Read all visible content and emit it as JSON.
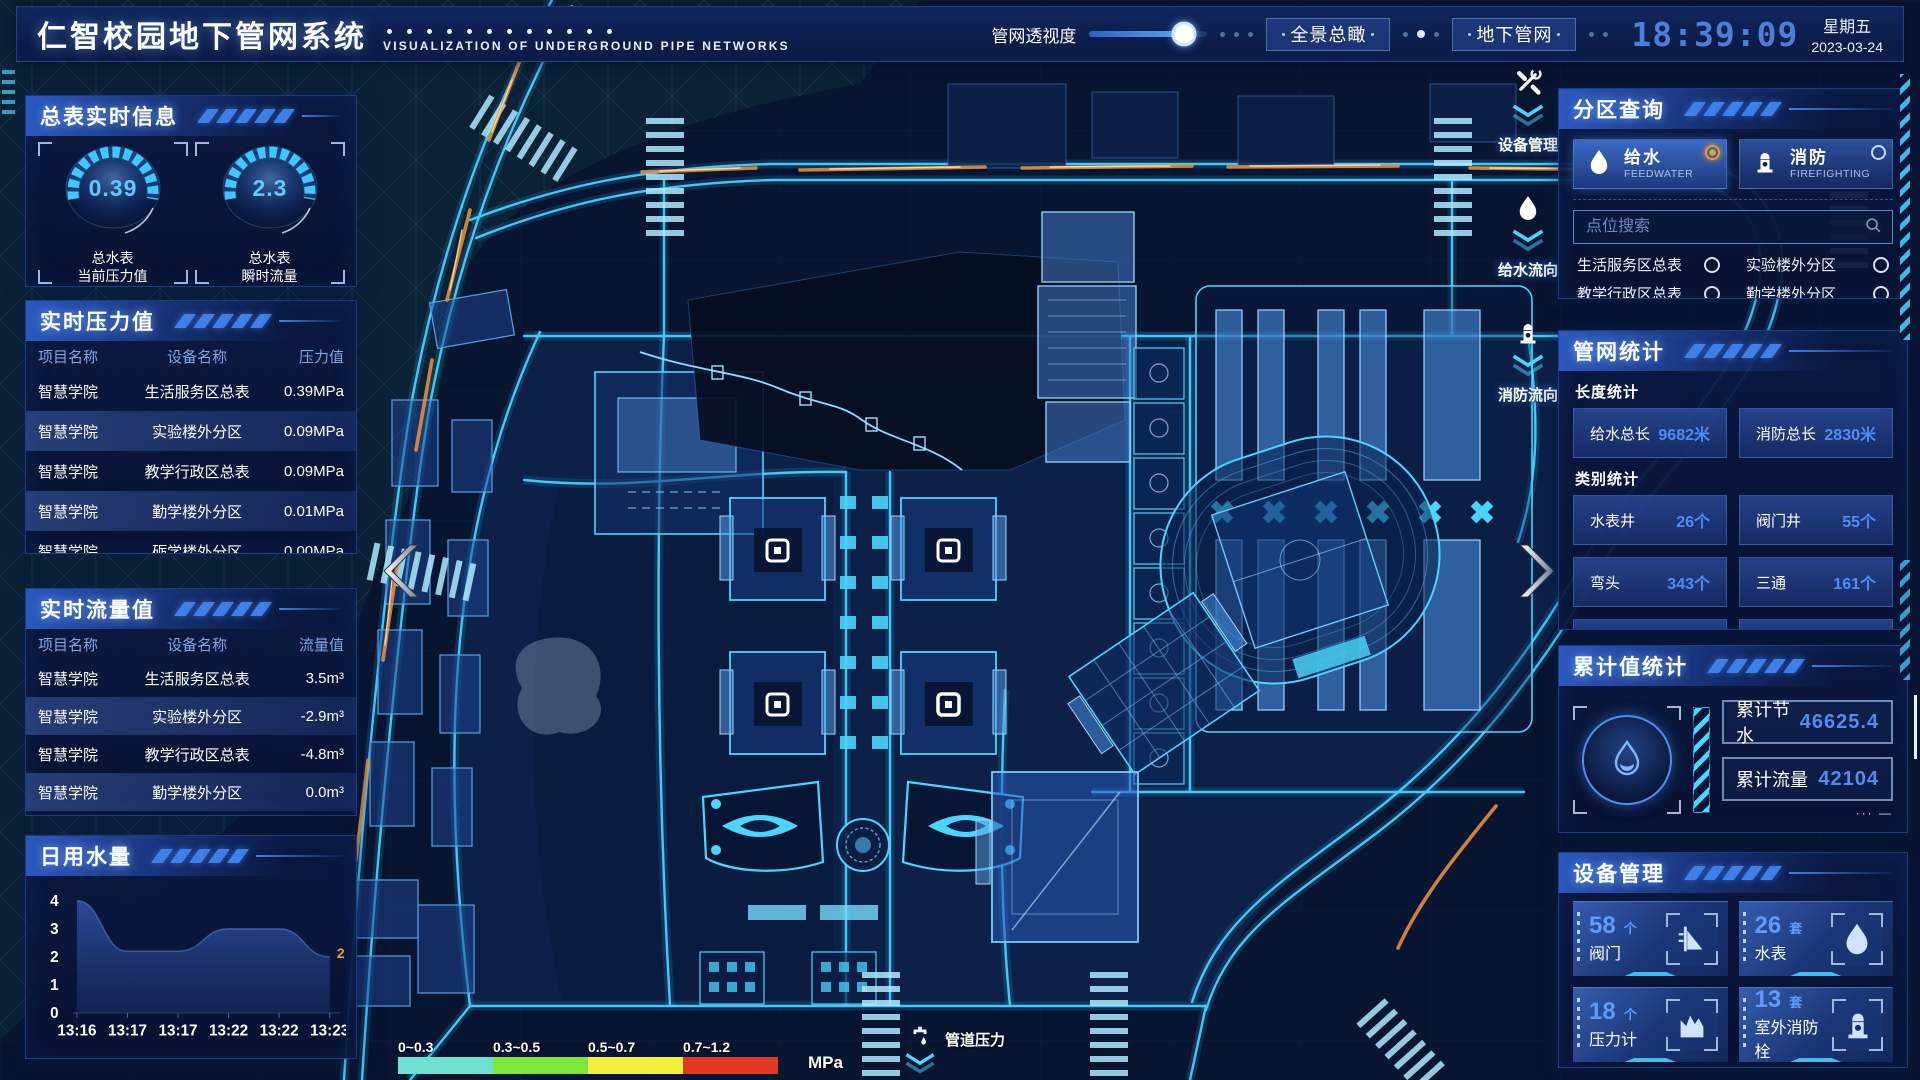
{
  "header": {
    "title": "仁智校园地下管网系统",
    "subtitle": "VISUALIZATION OF UNDERGROUND PIPE NETWORKS",
    "transparency_label": "管网透视度",
    "transparency_value": 80,
    "btn_overview": "全景总瞰",
    "btn_underground": "地下管网",
    "clock": "18:39:09",
    "weekday": "星期五",
    "date": "2023-03-24"
  },
  "left": {
    "master_meter": {
      "title": "总表实时信息",
      "gauges": [
        {
          "value": "0.39",
          "label1": "总水表",
          "label2": "当前压力值"
        },
        {
          "value": "2.3",
          "label1": "总水表",
          "label2": "瞬时流量"
        }
      ]
    },
    "pressure": {
      "title": "实时压力值",
      "headers": [
        "项目名称",
        "设备名称",
        "压力值"
      ],
      "rows": [
        [
          "智慧学院",
          "生活服务区总表",
          "0.39MPa"
        ],
        [
          "智慧学院",
          "实验楼外分区",
          "0.09MPa"
        ],
        [
          "智慧学院",
          "教学行政区总表",
          "0.09MPa"
        ],
        [
          "智慧学院",
          "勤学楼外分区",
          "0.01MPa"
        ],
        [
          "智慧学院",
          "砺学楼外分区",
          "0.00MPa"
        ]
      ]
    },
    "flow": {
      "title": "实时流量值",
      "headers": [
        "项目名称",
        "设备名称",
        "流量值"
      ],
      "rows": [
        [
          "智慧学院",
          "生活服务区总表",
          "3.5m³"
        ],
        [
          "智慧学院",
          "实验楼外分区",
          "-2.9m³"
        ],
        [
          "智慧学院",
          "教学行政区总表",
          "-4.8m³"
        ],
        [
          "智慧学院",
          "勤学楼外分区",
          "0.0m³"
        ],
        [
          "智慧学院",
          "砺学楼外分区",
          "2.3m³"
        ]
      ]
    },
    "daily_usage": {
      "title": "日用水量",
      "chart": {
        "type": "area",
        "categories": [
          "13:16",
          "13:17",
          "13:17",
          "13:22",
          "13:22",
          "13:23"
        ],
        "values": [
          4,
          2.2,
          2.2,
          3,
          3,
          2
        ],
        "ylim": [
          0,
          4
        ],
        "yticks": [
          0,
          1,
          2,
          3,
          4
        ],
        "end_label": "2",
        "end_label_color": "#d9a62e"
      }
    }
  },
  "map": {
    "toolbar": [
      {
        "icon": "wrench-icon",
        "label": "设备管理"
      },
      {
        "icon": "waterdrop-icon",
        "label": "给水流向"
      },
      {
        "icon": "hydrant-icon",
        "label": "消防流向"
      }
    ],
    "legend": {
      "ranges": [
        {
          "label": "0~0.3",
          "color": "#6ee0cf"
        },
        {
          "label": "0.3~0.5",
          "color": "#7ce83e"
        },
        {
          "label": "0.5~0.7",
          "color": "#f4ef3d"
        },
        {
          "label": "0.7~1.2",
          "color": "#e23723"
        }
      ],
      "unit": "MPa",
      "pipe_pressure_label": "管道压力"
    }
  },
  "right": {
    "zone_query": {
      "title": "分区查询",
      "tabs": [
        {
          "label": "给水",
          "sub": "FEEDWATER",
          "selected": true
        },
        {
          "label": "消防",
          "sub": "FIREFIGHTING",
          "selected": false
        }
      ],
      "search_placeholder": "点位搜索",
      "zones": [
        "生活服务区总表",
        "实验楼外分区",
        "教学行政区总表",
        "勤学楼外分区",
        "砺学楼外分区",
        "宿舍区泵房"
      ]
    },
    "pipe_stats": {
      "title": "管网统计",
      "length_title": "长度统计",
      "length_stats": [
        {
          "label": "给水总长",
          "value": "9682米"
        },
        {
          "label": "消防总长",
          "value": "2830米"
        }
      ],
      "category_title": "类别统计",
      "category_stats": [
        {
          "label": "水表井",
          "value": "26个"
        },
        {
          "label": "阀门井",
          "value": "55个"
        },
        {
          "label": "弯头",
          "value": "343个"
        },
        {
          "label": "三通",
          "value": "161个"
        }
      ]
    },
    "cumulative": {
      "title": "累计值统计",
      "rows": [
        {
          "label": "累计节水",
          "value": "46625.4"
        },
        {
          "label": "累计流量",
          "value": "42104"
        }
      ]
    },
    "devices": {
      "title": "设备管理",
      "cards": [
        {
          "count": "58",
          "unit": "个",
          "label": "阀门",
          "icon": "valve-icon"
        },
        {
          "count": "26",
          "unit": "套",
          "label": "水表",
          "icon": "water-meter-icon"
        },
        {
          "count": "18",
          "unit": "个",
          "label": "压力计",
          "icon": "pressure-gauge-icon"
        },
        {
          "count": "13",
          "unit": "套",
          "label": "室外消防栓",
          "icon": "outdoor-hydrant-icon"
        }
      ]
    }
  }
}
